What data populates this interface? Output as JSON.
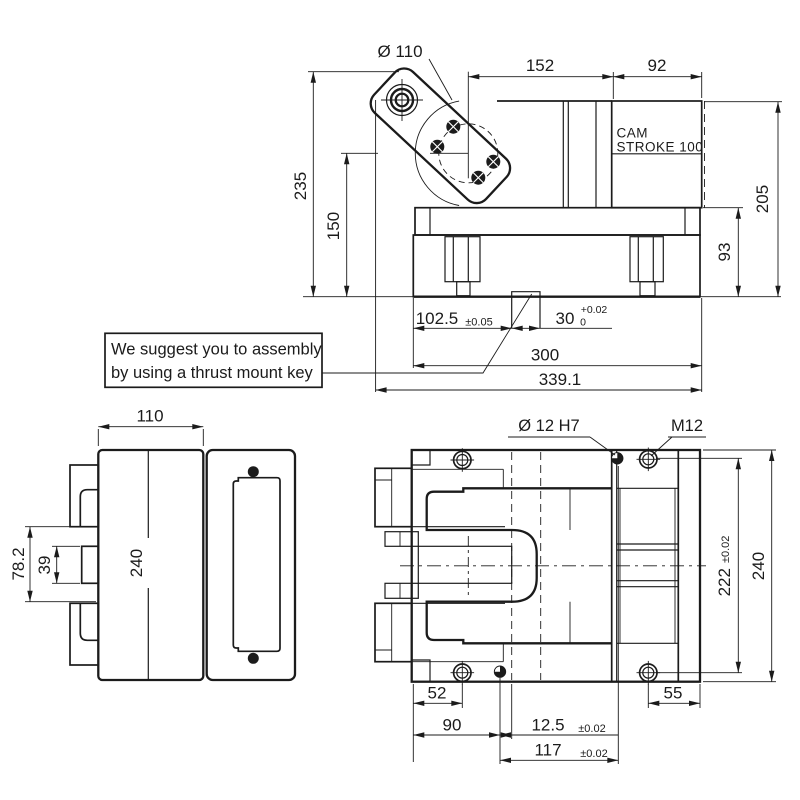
{
  "drawing": {
    "background": "#ffffff",
    "line_color": "#1b1b1b",
    "callout": {
      "line1": "We suggest you to assembly",
      "line2": "by using a thrust mount key"
    },
    "top_view": {
      "dia_label": "Ø 110",
      "dim_top_left": "152",
      "dim_top_right": "92",
      "stroke_label_line1": "CAM",
      "stroke_label_line2": "STROKE 100",
      "dim_height_total": "235",
      "dim_height_center": "150",
      "dim_height_right": "205",
      "dim_height_base": "93",
      "dim_key_left": "102.5",
      "tol_key_left": "±0.05",
      "dim_key_width": "30",
      "tol_key_upper": "+0.02",
      "tol_key_lower": "0",
      "dim_body": "300",
      "dim_overall": "339.1"
    },
    "side_view": {
      "dim_width": "110",
      "dim_height": "240",
      "dim_gap": "78.2",
      "dim_tab": "39"
    },
    "front_view": {
      "dowel_label": "Ø 12 H7",
      "thread_label": "M12",
      "dim_bolt_span": "222",
      "tol_bolt_span": "±0.02",
      "dim_height": "240",
      "dim_screw": "52",
      "dim_dowel": "90",
      "dim_thread_edge": "55",
      "dim_slot_offset": "12.5",
      "tol_slot_offset": "±0.02",
      "dim_dowel_span": "117",
      "tol_dowel_span": "±0.02"
    }
  }
}
